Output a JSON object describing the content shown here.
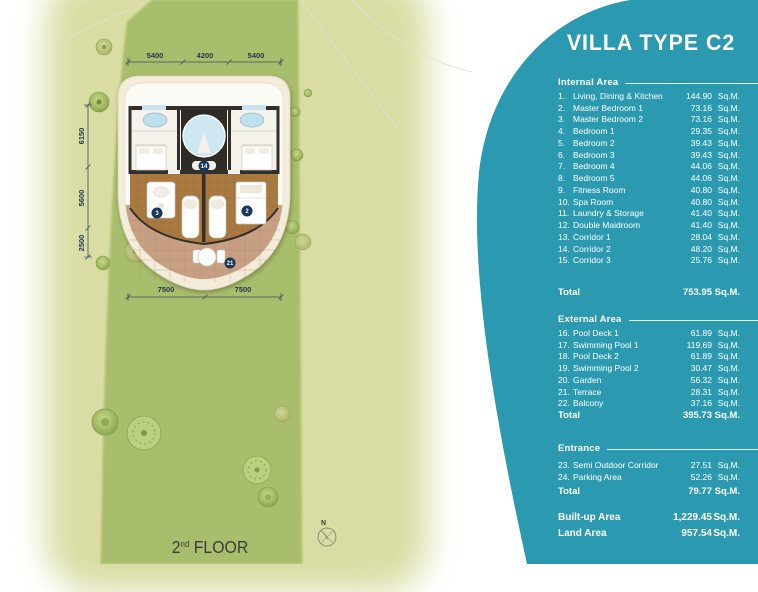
{
  "colors": {
    "accent_teal": "#2B9AB1",
    "site_green": "#A9BE6C",
    "background_olive": "#D9DDA3",
    "wood_floor": "#A87940",
    "terrace_tile": "#C79F82",
    "badge_navy": "#17375C",
    "tub_blue": "#BFE0EE"
  },
  "panel": {
    "title": "VILLA TYPE C2",
    "unit": "Sq.M.",
    "total_label": "Total",
    "sections": [
      {
        "name": "Internal Area",
        "items": [
          {
            "no": "1.",
            "label": "Living, Dining & Kitchen",
            "value": "144.90"
          },
          {
            "no": "2.",
            "label": "Master Bedroom 1",
            "value": "73.16"
          },
          {
            "no": "3.",
            "label": "Master Bedroom 2",
            "value": "73.16"
          },
          {
            "no": "4.",
            "label": "Bedroom 1",
            "value": "29.35"
          },
          {
            "no": "5.",
            "label": "Bedroom 2",
            "value": "39.43"
          },
          {
            "no": "6.",
            "label": "Bedroom 3",
            "value": "39.43"
          },
          {
            "no": "7.",
            "label": "Bedroom 4",
            "value": "44.06"
          },
          {
            "no": "8.",
            "label": "Bedroom 5",
            "value": "44.06"
          },
          {
            "no": "9.",
            "label": "Fitness Room",
            "value": "40.80"
          },
          {
            "no": "10.",
            "label": "Spa Room",
            "value": "40.80"
          },
          {
            "no": "11.",
            "label": "Laundry & Storage",
            "value": "41.40"
          },
          {
            "no": "12.",
            "label": "Double Maidroom",
            "value": "41.40"
          },
          {
            "no": "13.",
            "label": "Corridor 1",
            "value": "28.04"
          },
          {
            "no": "14.",
            "label": "Corridor 2",
            "value": "48.20"
          },
          {
            "no": "15.",
            "label": "Corridor 3",
            "value": "25.76"
          }
        ],
        "total": "753.95"
      },
      {
        "name": "External Area",
        "items": [
          {
            "no": "16.",
            "label": "Pool Deck 1",
            "value": "61.89"
          },
          {
            "no": "17.",
            "label": "Swimming Pool 1",
            "value": "119.69"
          },
          {
            "no": "18.",
            "label": "Pool Deck 2",
            "value": "61.89"
          },
          {
            "no": "19.",
            "label": "Swimming Pool 2",
            "value": "30.47"
          },
          {
            "no": "20.",
            "label": "Garden",
            "value": "56.32"
          },
          {
            "no": "21.",
            "label": "Terrace",
            "value": "28.31"
          },
          {
            "no": "22.",
            "label": "Balcony",
            "value": "37.16"
          }
        ],
        "total": "395.73"
      },
      {
        "name": "Entrance",
        "items": [
          {
            "no": "23.",
            "label": "Semi Outdoor Corridor",
            "value": "27.51"
          },
          {
            "no": "24.",
            "label": "Parking Area",
            "value": "52.26"
          }
        ],
        "total": "79.77"
      }
    ],
    "summary": [
      {
        "label": "Built-up Area",
        "value": "1,229.45"
      },
      {
        "label": "Land Area",
        "value": "957.54"
      }
    ]
  },
  "plan": {
    "floor": {
      "num": "2",
      "sup": "nd",
      "word": " FLOOR"
    },
    "compass": "N",
    "dims": {
      "top": [
        "5400",
        "4200",
        "5400"
      ],
      "left": [
        "6150",
        "5600",
        "2500"
      ],
      "bottom": [
        "7500",
        "7500"
      ]
    },
    "badges": {
      "center": "14",
      "left": "3",
      "right": "2",
      "terrace": "21"
    }
  }
}
